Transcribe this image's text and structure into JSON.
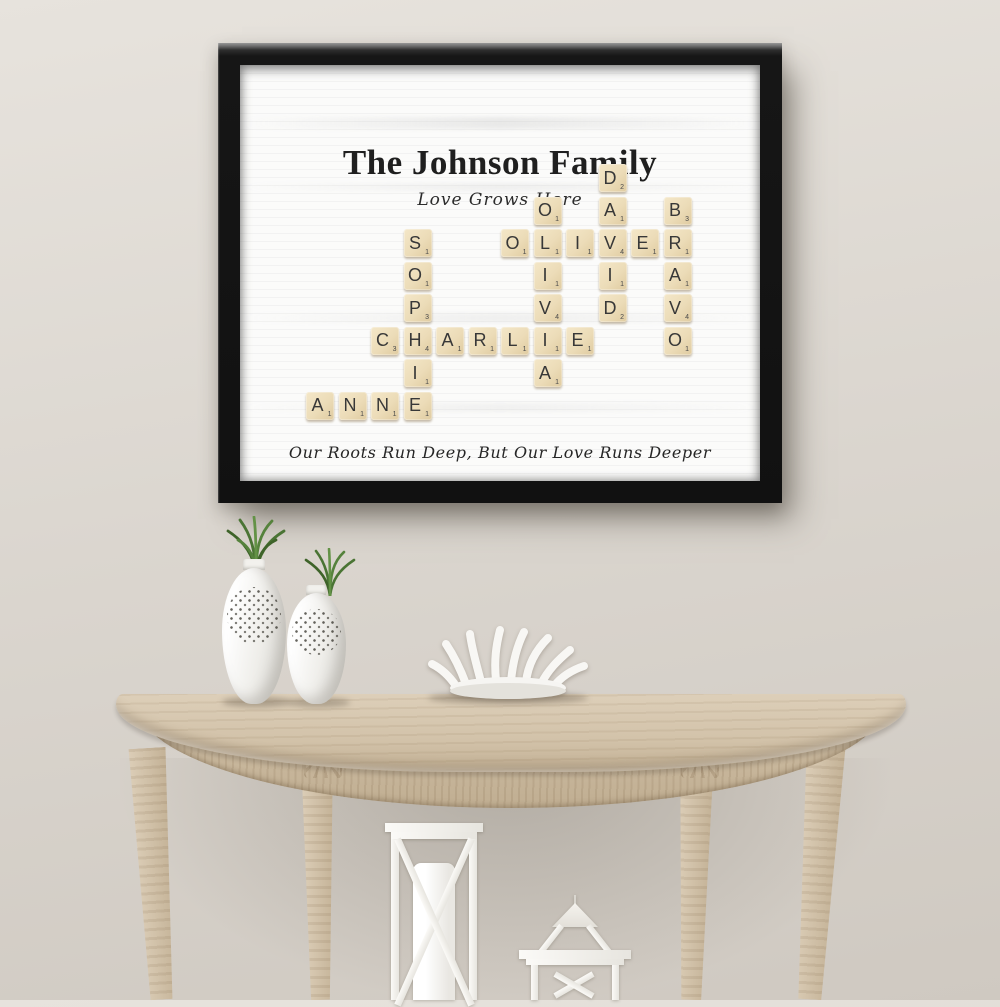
{
  "poster": {
    "title": "The Johnson Family",
    "subtitle": "Love Grows Here",
    "quote": "Our Roots Run Deep, But Our Love Runs Deeper",
    "names": [
      "ANNE",
      "SOPHIE",
      "CHARLIE",
      "OLIVER",
      "OLIVIA",
      "DAVID",
      "BRAVO"
    ],
    "grid": {
      "rows": 8,
      "cols": 12,
      "cell_px": 32.5,
      "tile_px": 28
    },
    "tiles": [
      {
        "row": 1,
        "col": 9,
        "letter": "D",
        "value": 2
      },
      {
        "row": 2,
        "col": 7,
        "letter": "O",
        "value": 1
      },
      {
        "row": 2,
        "col": 9,
        "letter": "A",
        "value": 1
      },
      {
        "row": 2,
        "col": 11,
        "letter": "B",
        "value": 3
      },
      {
        "row": 3,
        "col": 3,
        "letter": "S",
        "value": 1
      },
      {
        "row": 3,
        "col": 6,
        "letter": "O",
        "value": 1
      },
      {
        "row": 3,
        "col": 7,
        "letter": "L",
        "value": 1
      },
      {
        "row": 3,
        "col": 8,
        "letter": "I",
        "value": 1
      },
      {
        "row": 3,
        "col": 9,
        "letter": "V",
        "value": 4
      },
      {
        "row": 3,
        "col": 10,
        "letter": "E",
        "value": 1
      },
      {
        "row": 3,
        "col": 11,
        "letter": "R",
        "value": 1
      },
      {
        "row": 4,
        "col": 3,
        "letter": "O",
        "value": 1
      },
      {
        "row": 4,
        "col": 7,
        "letter": "I",
        "value": 1
      },
      {
        "row": 4,
        "col": 9,
        "letter": "I",
        "value": 1
      },
      {
        "row": 4,
        "col": 11,
        "letter": "A",
        "value": 1
      },
      {
        "row": 5,
        "col": 3,
        "letter": "P",
        "value": 3
      },
      {
        "row": 5,
        "col": 7,
        "letter": "V",
        "value": 4
      },
      {
        "row": 5,
        "col": 9,
        "letter": "D",
        "value": 2
      },
      {
        "row": 5,
        "col": 11,
        "letter": "V",
        "value": 4
      },
      {
        "row": 6,
        "col": 2,
        "letter": "C",
        "value": 3
      },
      {
        "row": 6,
        "col": 3,
        "letter": "H",
        "value": 4
      },
      {
        "row": 6,
        "col": 4,
        "letter": "A",
        "value": 1
      },
      {
        "row": 6,
        "col": 5,
        "letter": "R",
        "value": 1
      },
      {
        "row": 6,
        "col": 6,
        "letter": "L",
        "value": 1
      },
      {
        "row": 6,
        "col": 7,
        "letter": "I",
        "value": 1
      },
      {
        "row": 6,
        "col": 8,
        "letter": "E",
        "value": 1
      },
      {
        "row": 6,
        "col": 11,
        "letter": "O",
        "value": 1
      },
      {
        "row": 7,
        "col": 3,
        "letter": "I",
        "value": 1
      },
      {
        "row": 7,
        "col": 7,
        "letter": "A",
        "value": 1
      },
      {
        "row": 8,
        "col": 0,
        "letter": "A",
        "value": 1
      },
      {
        "row": 8,
        "col": 1,
        "letter": "N",
        "value": 1
      },
      {
        "row": 8,
        "col": 2,
        "letter": "N",
        "value": 1
      },
      {
        "row": 8,
        "col": 3,
        "letter": "E",
        "value": 1
      }
    ]
  },
  "scene": {
    "decor_items": [
      "pierced-vase-with-grass-left",
      "pierced-vase-with-grass-right",
      "coral-bowl",
      "tall-lantern-with-candle",
      "small-lantern",
      "demilune-console-table",
      "black-picture-frame"
    ]
  },
  "colors": {
    "wall_light": "#e7e3dd",
    "wall_mid": "#dad5ce",
    "wall_dark": "#cfc9c1",
    "frame": "#161616",
    "canvas": "#fbfbfa",
    "ink": "#1f1f1f",
    "tile": "#ecdcb8",
    "tile_light": "#f4e7c8",
    "tile_dark": "#dfcba0",
    "tile_text": "#383838",
    "wood_light": "#ddcfb9",
    "wood": "#d2c2a9",
    "wood_dark": "#c2b094",
    "ceramic": "#efeeea",
    "plant": "#55823c"
  }
}
